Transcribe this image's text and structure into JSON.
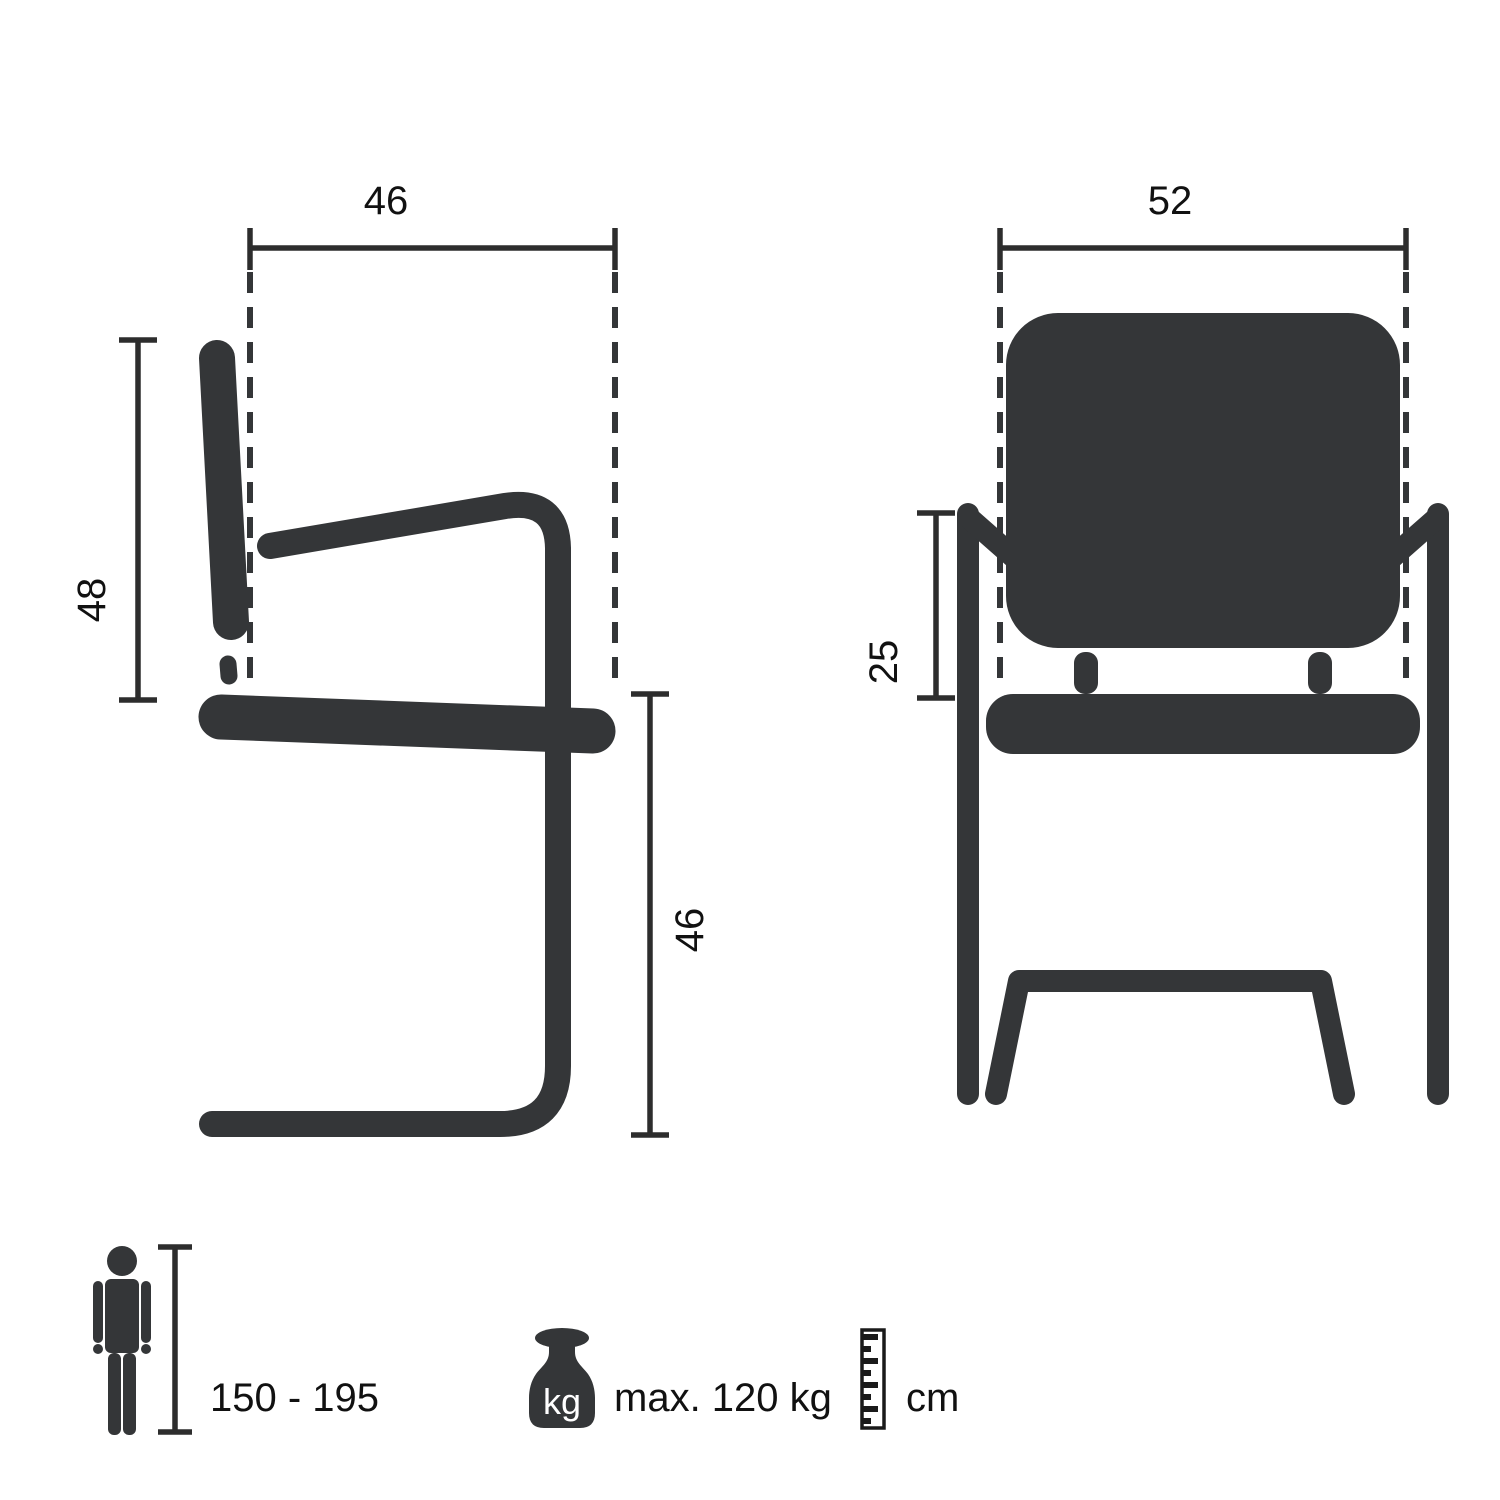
{
  "page": {
    "background": "#ffffff"
  },
  "colors": {
    "chair": "#343638",
    "dimension_lines": "#2d2d2d",
    "text": "#111111",
    "kg_text": "#ffffff"
  },
  "side_view": {
    "name": "chair-side-view",
    "seat_depth_cm": "46",
    "backrest_height_cm": "48",
    "seat_height_cm": "46"
  },
  "front_view": {
    "name": "chair-front-view",
    "seat_width_cm": "52",
    "armrest_height_cm": "25"
  },
  "legend": {
    "person_height_range": "150 - 195",
    "weight_icon_label": "kg",
    "max_load": "max. 120 kg",
    "unit": "cm"
  }
}
